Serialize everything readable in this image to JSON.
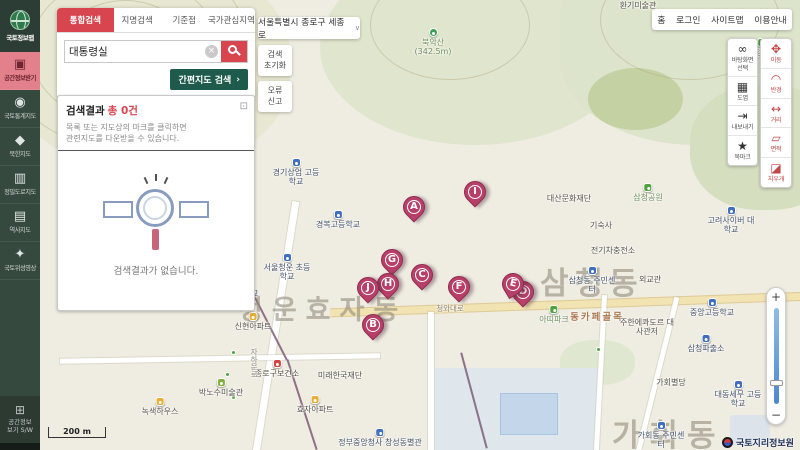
{
  "colors": {
    "accent_red": "#d8454f",
    "sidebar_green": "#36493f",
    "button_green": "#1e5b4c",
    "marker_pink": "#b83f68"
  },
  "sidebar": {
    "logo": "국토정보맵",
    "items": [
      {
        "icon": "▣",
        "label": "공간정보받기"
      },
      {
        "icon": "◉",
        "label": "국토통계지도"
      },
      {
        "icon": "◆",
        "label": "북한지도"
      },
      {
        "icon": "▥",
        "label": "정밀도로지도"
      },
      {
        "icon": "▤",
        "label": "역사지도"
      },
      {
        "icon": "✦",
        "label": "국토위성영상"
      }
    ],
    "bottom_icon": "⊞",
    "bottom_label": "공간정보\n보기 S/W"
  },
  "search": {
    "tabs": [
      {
        "label": "통합검색"
      },
      {
        "label": "지명검색"
      },
      {
        "label": "기준점"
      },
      {
        "label": "국가관심지역"
      }
    ],
    "query": "대통령실",
    "clear_icon": "×",
    "map_button": "간편지도 검색",
    "map_button_arrow": "›",
    "results_title": "검색결과",
    "results_count": "총 0건",
    "expand_icon": "⊡",
    "results_hint": "목록 또는 지도상의 마크를 클릭하면\n관련지도를 다운받을 수 있습니다.",
    "empty_text": "검색결과가 없습니다."
  },
  "topbar": {
    "region": "서울특별시 종로구 세종로",
    "chevron": "∨",
    "reset": "검색\n초기화",
    "report": "오류\n신고",
    "nav": [
      {
        "label": "홈"
      },
      {
        "label": "로그인"
      },
      {
        "label": "사이트맵"
      },
      {
        "label": "이용안내"
      }
    ]
  },
  "tools": {
    "left": [
      {
        "icon": "∞",
        "label": "바탕화면\n선택"
      },
      {
        "icon": "▦",
        "label": "도엽"
      },
      {
        "icon": "⇥",
        "label": "내보내기"
      },
      {
        "icon": "★",
        "label": "북마크"
      }
    ],
    "right": [
      {
        "icon": "✥",
        "label": "이동"
      },
      {
        "icon": "◠",
        "label": "반경"
      },
      {
        "icon": "↔",
        "label": "거리"
      },
      {
        "icon": "▱",
        "label": "면적"
      },
      {
        "icon": "◪",
        "label": "지우개"
      }
    ]
  },
  "zoom": {
    "in": "+",
    "out": "−"
  },
  "map": {
    "scale": "200 m",
    "attribution": "국토지리정보원",
    "districts": [
      {
        "name": "청운효자동"
      },
      {
        "name": "삼청동"
      },
      {
        "name": "가회동"
      }
    ],
    "markers": [
      {
        "letter": "A"
      },
      {
        "letter": "B"
      },
      {
        "letter": "C"
      },
      {
        "letter": "D"
      },
      {
        "letter": "E"
      },
      {
        "letter": "F"
      },
      {
        "letter": "G"
      },
      {
        "letter": "H"
      },
      {
        "letter": "I"
      },
      {
        "letter": "J"
      }
    ],
    "labels": [
      {
        "text": "환기미술관"
      },
      {
        "text": "북악산 (342.5m)"
      },
      {
        "text": "삼청공원"
      },
      {
        "text": "경기상업 고등학교"
      },
      {
        "text": "경복고등학교"
      },
      {
        "text": "서울청운 초등학교"
      },
      {
        "text": "서울맹학교"
      },
      {
        "text": "신현아파트"
      },
      {
        "text": "종로구보건소"
      },
      {
        "text": "박노수미술관"
      },
      {
        "text": "녹색하우스"
      },
      {
        "text": "효자아파트"
      },
      {
        "text": "미래한국재단"
      },
      {
        "text": "정부중앙청사 창성동별관"
      },
      {
        "text": "대산문화재단"
      },
      {
        "text": "삼청공원"
      },
      {
        "text": "기숙사"
      },
      {
        "text": "전기차충전소"
      },
      {
        "text": "삼청동 주민센터"
      },
      {
        "text": "외교관"
      },
      {
        "text": "고려사이버 대학교"
      },
      {
        "text": "아띠파크"
      },
      {
        "text": "동카페골목"
      },
      {
        "text": "주한에콰도르 대사관저"
      },
      {
        "text": "중앙고등학교"
      },
      {
        "text": "삼청파출소"
      },
      {
        "text": "가회별당"
      },
      {
        "text": "대동세무 고등학교"
      },
      {
        "text": "가회동 주민센터"
      },
      {
        "text": "청와대로"
      },
      {
        "text": "자하문로"
      }
    ]
  }
}
